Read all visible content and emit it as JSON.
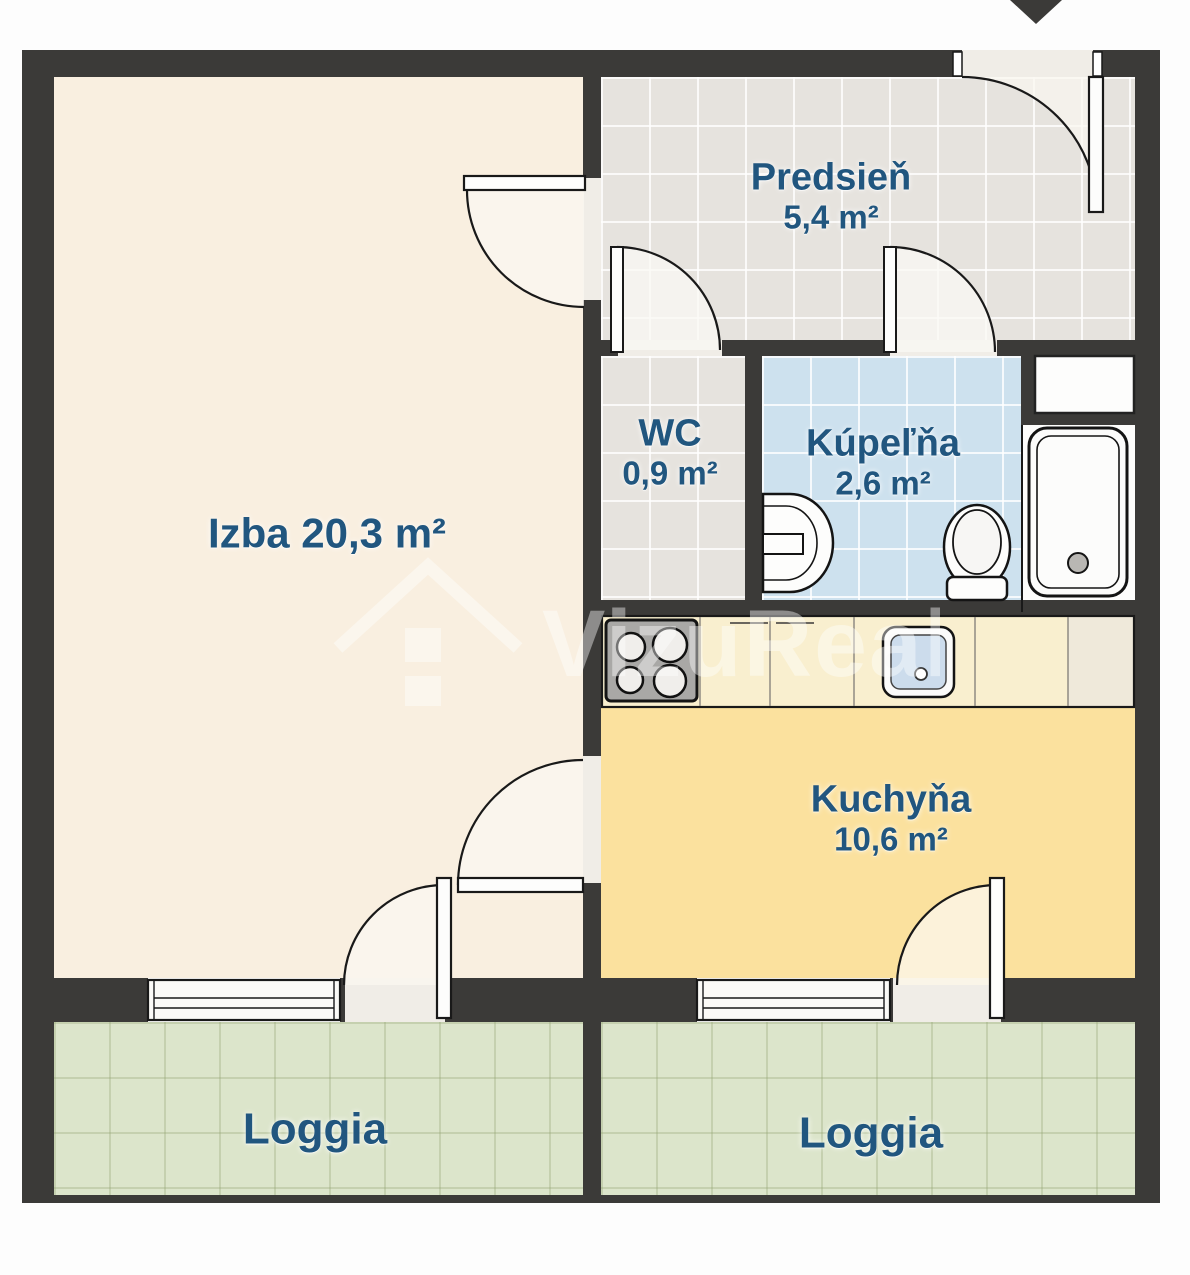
{
  "plan": {
    "watermark_text": "VizuReal",
    "rooms": {
      "predsien": {
        "name": "Predsieň",
        "area": "5,4 m²"
      },
      "wc": {
        "name": "WC",
        "area": "0,9 m²"
      },
      "kupelna": {
        "name": "Kúpeľňa",
        "area": "2,6 m²"
      },
      "izba": {
        "name": "Izba 20,3 m²"
      },
      "kuchyna": {
        "name": "Kuchyňa",
        "area": "10,6 m²"
      },
      "loggia_left": {
        "name": "Loggia"
      },
      "loggia_right": {
        "name": "Loggia"
      }
    },
    "fixtures": {
      "stove": "stove-cooktop",
      "kitchen_sink": "kitchen-sink",
      "washbasin": "bathroom-washbasin",
      "toilet": "toilet",
      "bathtub": "bathtub",
      "shaft": "utility-shaft",
      "entrance": "entrance-arrow"
    },
    "colors": {
      "wall": "#3b3a38",
      "izba_floor": "#f9efe0",
      "hallway_tile": "#e6e3de",
      "bathroom_tile": "#cde1ee",
      "kitchen_floor": "#fbe19e",
      "counter": "#f9efcf",
      "loggia_tile": "#dce5cb",
      "label_text": "#21567f"
    }
  }
}
